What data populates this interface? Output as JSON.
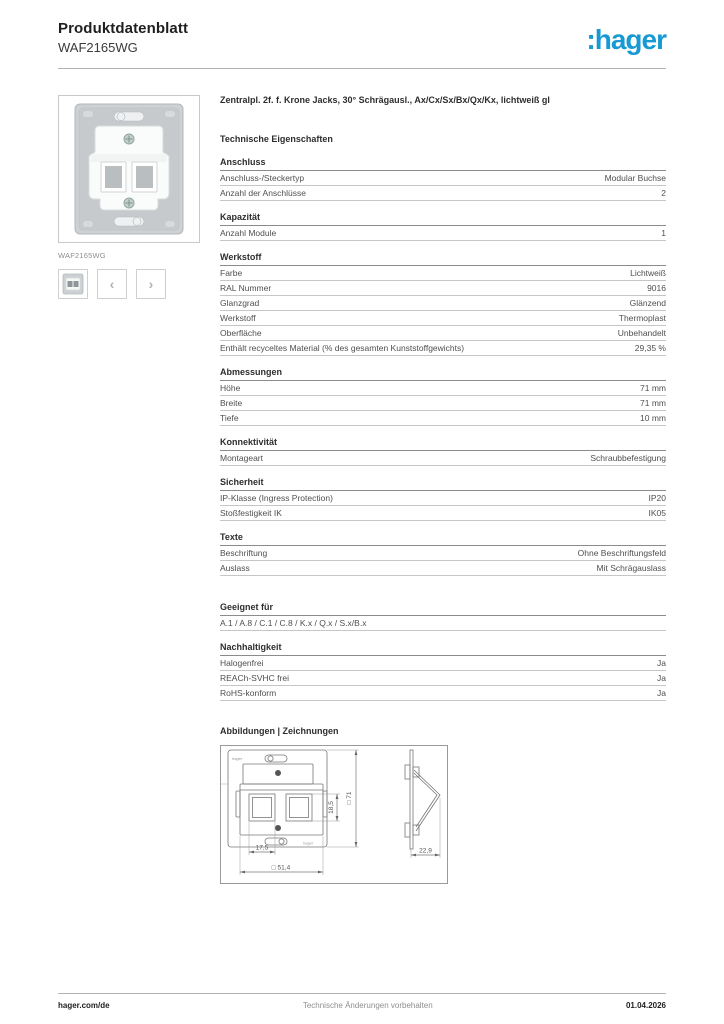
{
  "header": {
    "doc_type": "Produktdatenblatt",
    "product_ref": "WAF2165WG",
    "logo": ":hager",
    "logo_color": "#1799d4"
  },
  "sidebar": {
    "image_caption": "WAF2165WG",
    "prev": "‹",
    "next": "›"
  },
  "product_title": "Zentralpl. 2f. f. Krone Jacks, 30° Schrägausl., Ax/Cx/Sx/Bx/Qx/Kx, lichtweiß gl",
  "tech_heading": "Technische Eigenschaften",
  "sections": [
    {
      "title": "Anschluss",
      "rows": [
        {
          "label": "Anschluss-/Steckertyp",
          "value": "Modular Buchse"
        },
        {
          "label": "Anzahl der Anschlüsse",
          "value": "2"
        }
      ]
    },
    {
      "title": "Kapazität",
      "rows": [
        {
          "label": "Anzahl Module",
          "value": "1"
        }
      ]
    },
    {
      "title": "Werkstoff",
      "rows": [
        {
          "label": "Farbe",
          "value": "Lichtweiß"
        },
        {
          "label": "RAL Nummer",
          "value": "9016"
        },
        {
          "label": "Glanzgrad",
          "value": "Glänzend"
        },
        {
          "label": "Werkstoff",
          "value": "Thermoplast"
        },
        {
          "label": "Oberfläche",
          "value": "Unbehandelt"
        },
        {
          "label": "Enthält recyceltes Material (% des gesamten Kunststoffgewichts)",
          "value": "29,35 %"
        }
      ]
    },
    {
      "title": "Abmessungen",
      "rows": [
        {
          "label": "Höhe",
          "value": "71 mm"
        },
        {
          "label": "Breite",
          "value": "71 mm"
        },
        {
          "label": "Tiefe",
          "value": "10 mm"
        }
      ]
    },
    {
      "title": "Konnektivität",
      "rows": [
        {
          "label": "Montageart",
          "value": "Schraubbefestigung"
        }
      ]
    },
    {
      "title": "Sicherheit",
      "rows": [
        {
          "label": "IP-Klasse (Ingress Protection)",
          "value": "IP20"
        },
        {
          "label": "Stoßfestigkeit IK",
          "value": "IK05"
        }
      ]
    },
    {
      "title": "Texte",
      "rows": [
        {
          "label": "Beschriftung",
          "value": "Ohne Beschriftungsfeld"
        },
        {
          "label": "Auslass",
          "value": "Mit Schrägauslass"
        }
      ]
    },
    {
      "title": "Geeignet für",
      "extra_gap": true,
      "rows": [
        {
          "label": "A.1 / A.8 / C.1 / C.8 / K.x / Q.x / S.x/B.x",
          "value": ""
        }
      ]
    },
    {
      "title": "Nachhaltigkeit",
      "rows": [
        {
          "label": "Halogenfrei",
          "value": "Ja"
        },
        {
          "label": "REACh-SVHC frei",
          "value": "Ja"
        },
        {
          "label": "RoHS-konform",
          "value": "Ja"
        }
      ]
    }
  ],
  "drawings_heading": "Abbildungen | Zeichnungen",
  "drawing": {
    "brand_top": "hager",
    "brand_bottom": "hager",
    "dim_opening_width": "17,5",
    "dim_plate_width": "□ 51,4",
    "dim_opening_height": "18,5",
    "dim_overall_height": "□ 71",
    "dim_depth": "22,9"
  },
  "footer": {
    "site": "hager.com/de",
    "notice": "Technische Änderungen vorbehalten",
    "date": "01.04.2026"
  }
}
